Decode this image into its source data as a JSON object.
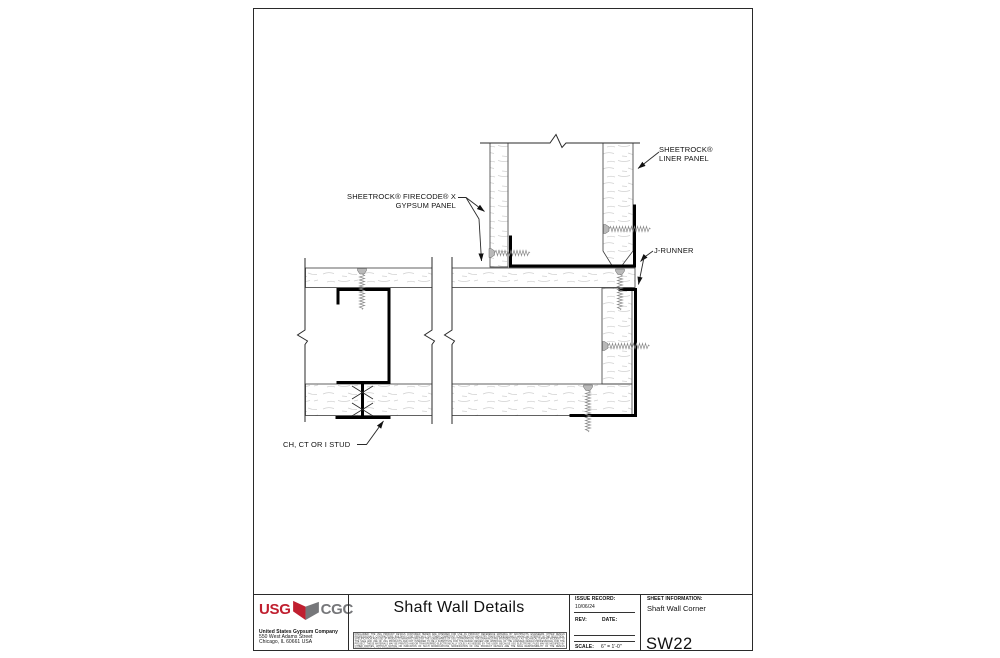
{
  "drawing": {
    "labels": {
      "liner_panel_line1": "SHEETROCK®",
      "liner_panel_line2": "LINER PANEL",
      "gypsum_panel_line1": "SHEETROCK® FIRECODE® X",
      "gypsum_panel_line2": "GYPSUM PANEL",
      "j_runner": "J-RUNNER",
      "stud": "CH, CT OR I STUD"
    }
  },
  "title_block": {
    "logo_usg": "USG",
    "logo_cgc": "CGC",
    "company_lines": [
      "United States Gypsum Company",
      "550 West Adams Street",
      "Chicago, IL 60661 USA"
    ],
    "drawing_title": "Shaft Wall Details",
    "disclaimer": "DISCLAIMER: THE USG PRODUCT DETAILS CONTAINED HEREIN ARE INTENDED FOR USE AS PRODUCT REFERENCE MATERIAL BY ARCHITECTS, ENGINEERS, OTHER DESIGN PROFESSIONALS, CONTRACTORS, BUILDING CODE OFFICIALS, OR OTHER COMPETENT CONSTRUCTION INDUSTRY TRADE PROFESSIONALS HAVING AN INTEREST IN THE SELECTION, SPECIFICATION AND USE OF PRODUCTS MANUFACTURED BY THE SUBSIDIARIES OF USG CORPORATION. THE DRAWINGS ARE INTENDED SOLELY AS TECHNICAL SUPPORT INCIDENT TO THE SALE AND USE OF USG PRODUCTS AND NOT INTENDED TO BE A SUBSTITUTE FOR THE DESIGN REVIEW AND APPROVAL OF THE LICENSED DESIGN PROFESSIONAL FOR THE PROJECT. THESE MATERIALS MAY BE PRINTED AND/OR TRANSFERRED ELECTRONICALLY SOLELY AS NEEDED BY THE USER. BECAUSE USG ELECTRONIC FILES MAY BE MODIFIED BY OTHER PARTIES, WITHOUT NOTICE OR INDICATION OF SUCH MODIFICATIONS, MODIFICATION OF USG PRODUCT DETAILS ARE THE SOLE RESPONSIBILITY OF THE DESIGN PROFESSIONAL. © USG CORPORATION",
    "issue_record_label": "ISSUE RECORD:",
    "issue_date": "10/06/24",
    "rev_label": "REV:",
    "date_label": "DATE:",
    "scale_label": "SCALE:",
    "scale_value": "6\" = 1'-0\"",
    "sheet_information_label": "SHEET INFORMATION:",
    "sheet_title": "Shaft Wall Corner",
    "sheet_number": "SW22"
  },
  "colors": {
    "usg_red": "#c01f2f",
    "cgc_gray": "#76777a"
  }
}
